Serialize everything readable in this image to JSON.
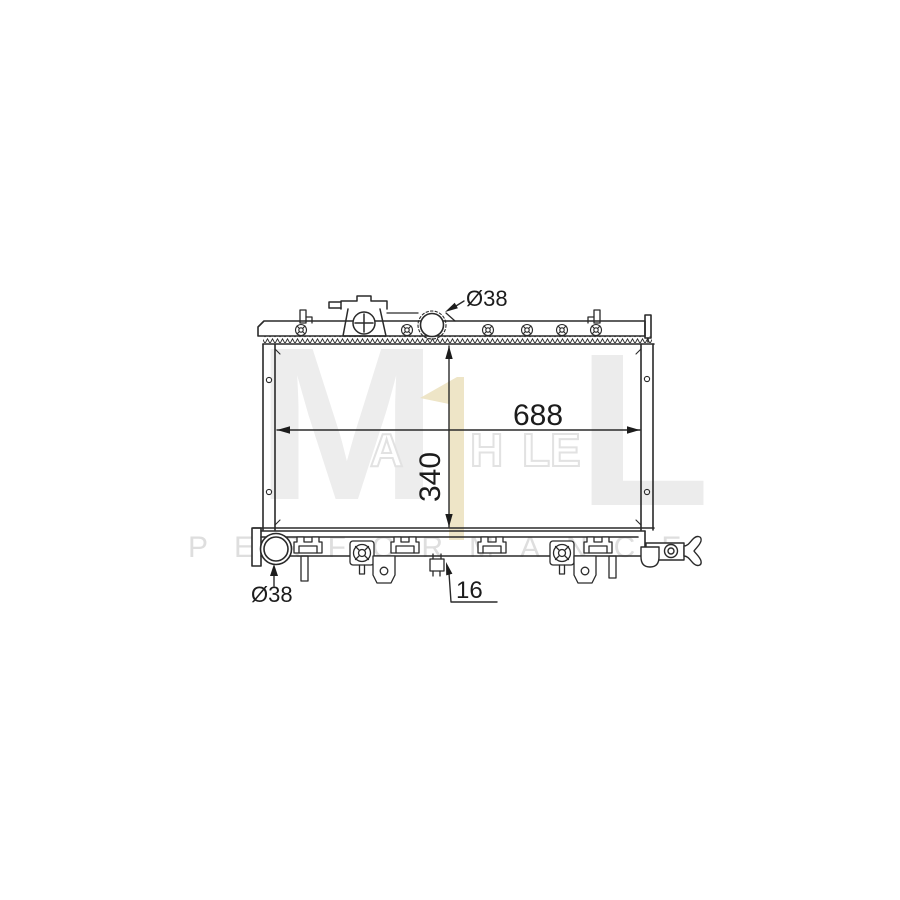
{
  "page": {
    "type": "radiator-technical-drawing",
    "background": "#ffffff",
    "line_color": "#2a2a2a"
  },
  "dimensions": {
    "inlet_top": "Ø38",
    "core_width": "688",
    "core_height": "340",
    "outlet_bottom": "Ø38",
    "pitch": "16"
  },
  "watermark": {
    "brand": "MAHLE",
    "letter_m": "M",
    "letter_a": "A",
    "letter_h": "H",
    "letter_l_small": "L",
    "letter_e": "E",
    "letter_l_big": "L",
    "performance": "PERFORMANCE",
    "color_gray": "#ededed",
    "color_tan": "#ebe1bd"
  }
}
